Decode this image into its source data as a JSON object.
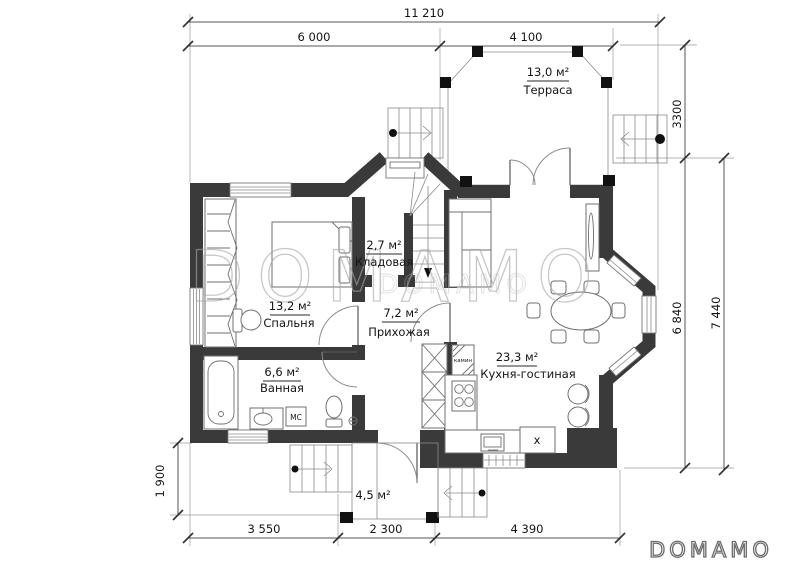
{
  "watermark": {
    "large": "DOMAMO",
    "small": "DOMAMO"
  },
  "logo": {
    "text": "DOMAMO"
  },
  "colors": {
    "wall": "#3a3a3a",
    "thin_line": "#777777",
    "text": "#141414",
    "watermark": "#a7a7a7"
  },
  "dimensions": {
    "total_width": "11 210",
    "width_left": "6 000",
    "width_right": "4 100",
    "terrace_depth": "3300",
    "house_depth_inner": "6 840",
    "house_depth_outer": "7 440",
    "porch_depth": "1 900",
    "bottom_left": "3 550",
    "bottom_center": "2 300",
    "bottom_right": "4 390"
  },
  "rooms": {
    "terrace": {
      "area": "13,0 м²",
      "name": "Терраса"
    },
    "storage": {
      "area": "2,7 м²",
      "name": "Кладовая"
    },
    "bedroom": {
      "area": "13,2 м²",
      "name": "Спальня"
    },
    "hallway": {
      "area": "7,2 м²",
      "name": "Прихожая"
    },
    "bathroom": {
      "area": "6,6 м²",
      "name": "Ванная"
    },
    "kitchen_living": {
      "area": "23,3 м²",
      "name": "Кухня-гостиная"
    },
    "porch": {
      "area": "4,5 м²"
    }
  },
  "annotations": {
    "fireplace": "камин",
    "washer": "МС",
    "hood": "x"
  }
}
